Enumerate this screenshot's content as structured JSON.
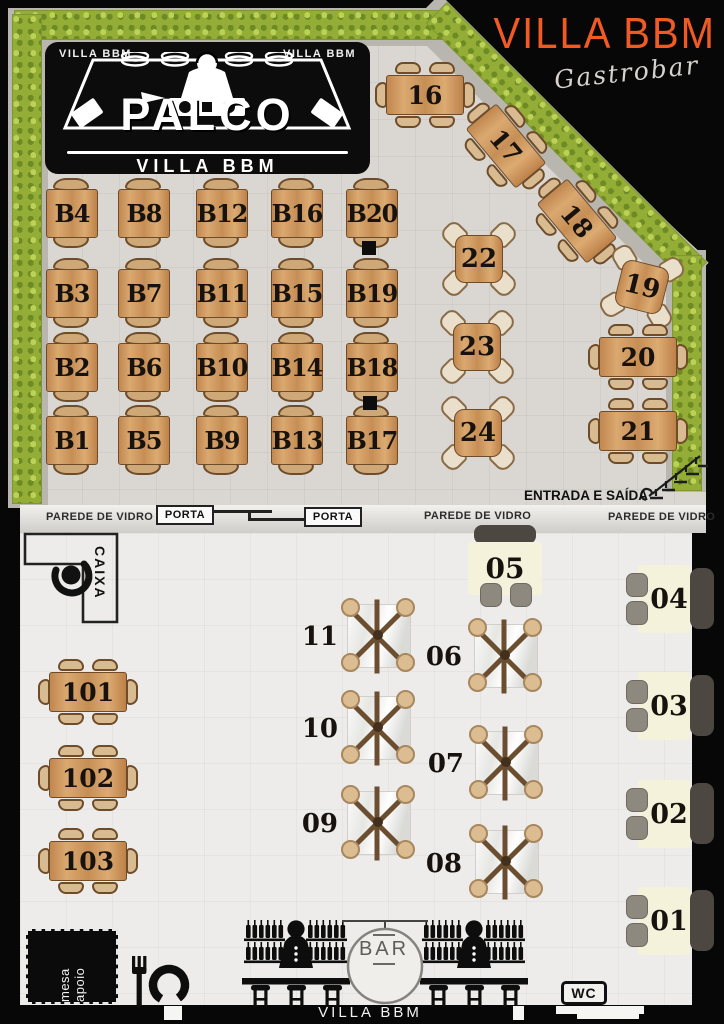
{
  "colors": {
    "accent": "#f15a24",
    "wood": "#cf9a62",
    "hedge": "#93ad36",
    "cream": "#f4f2da",
    "bench": "#4c4841",
    "chair_gray": "#8e897f"
  },
  "brand": {
    "title": "VILLA BBM",
    "subtitle": "Gastrobar"
  },
  "stage": {
    "corner_left": "VILLA BBM",
    "corner_right": "VILLA BBM",
    "title": "PALCO",
    "subtitle": "VILLA BBM"
  },
  "outdoor": {
    "b_rows": [
      [
        "B4",
        "B8",
        "B12",
        "B16",
        "B20"
      ],
      [
        "B3",
        "B7",
        "B11",
        "B15",
        "B19"
      ],
      [
        "B2",
        "B6",
        "B10",
        "B14",
        "B18"
      ],
      [
        "B1",
        "B5",
        "B9",
        "B13",
        "B17"
      ]
    ],
    "table_16": "16",
    "table_17": "17",
    "table_18": "18",
    "table_19": "19",
    "table_20": "20",
    "table_21": "21",
    "table_22": "22",
    "table_23": "23",
    "table_24": "24",
    "entrance_label": "ENTRADA E SAÍDA"
  },
  "divider": {
    "glass_left": "PAREDE DE VIDRO",
    "door_left": "PORTA",
    "door_right": "PORTA",
    "glass_mid": "PAREDE DE VIDRO",
    "glass_right": "PAREDE DE VIDRO"
  },
  "indoor": {
    "cashier": "CAIXA",
    "table_05": "05",
    "booths": [
      "04",
      "03",
      "02",
      "01"
    ],
    "x_left": [
      "11",
      "10",
      "09"
    ],
    "x_right": [
      "06",
      "07",
      "08"
    ],
    "left_tables": [
      "101",
      "102",
      "103"
    ],
    "bar_sign": "BAR",
    "bar_brand": "VILLA BBM",
    "support": "mesa apoio",
    "wc": "WC"
  },
  "icons": {
    "dj": "dj-booth-icon",
    "cashier": "person-top-view-icon",
    "stairs": "staircase-icon",
    "bartender": "bartender-icon",
    "cutlery": "fork-plate-icon"
  }
}
